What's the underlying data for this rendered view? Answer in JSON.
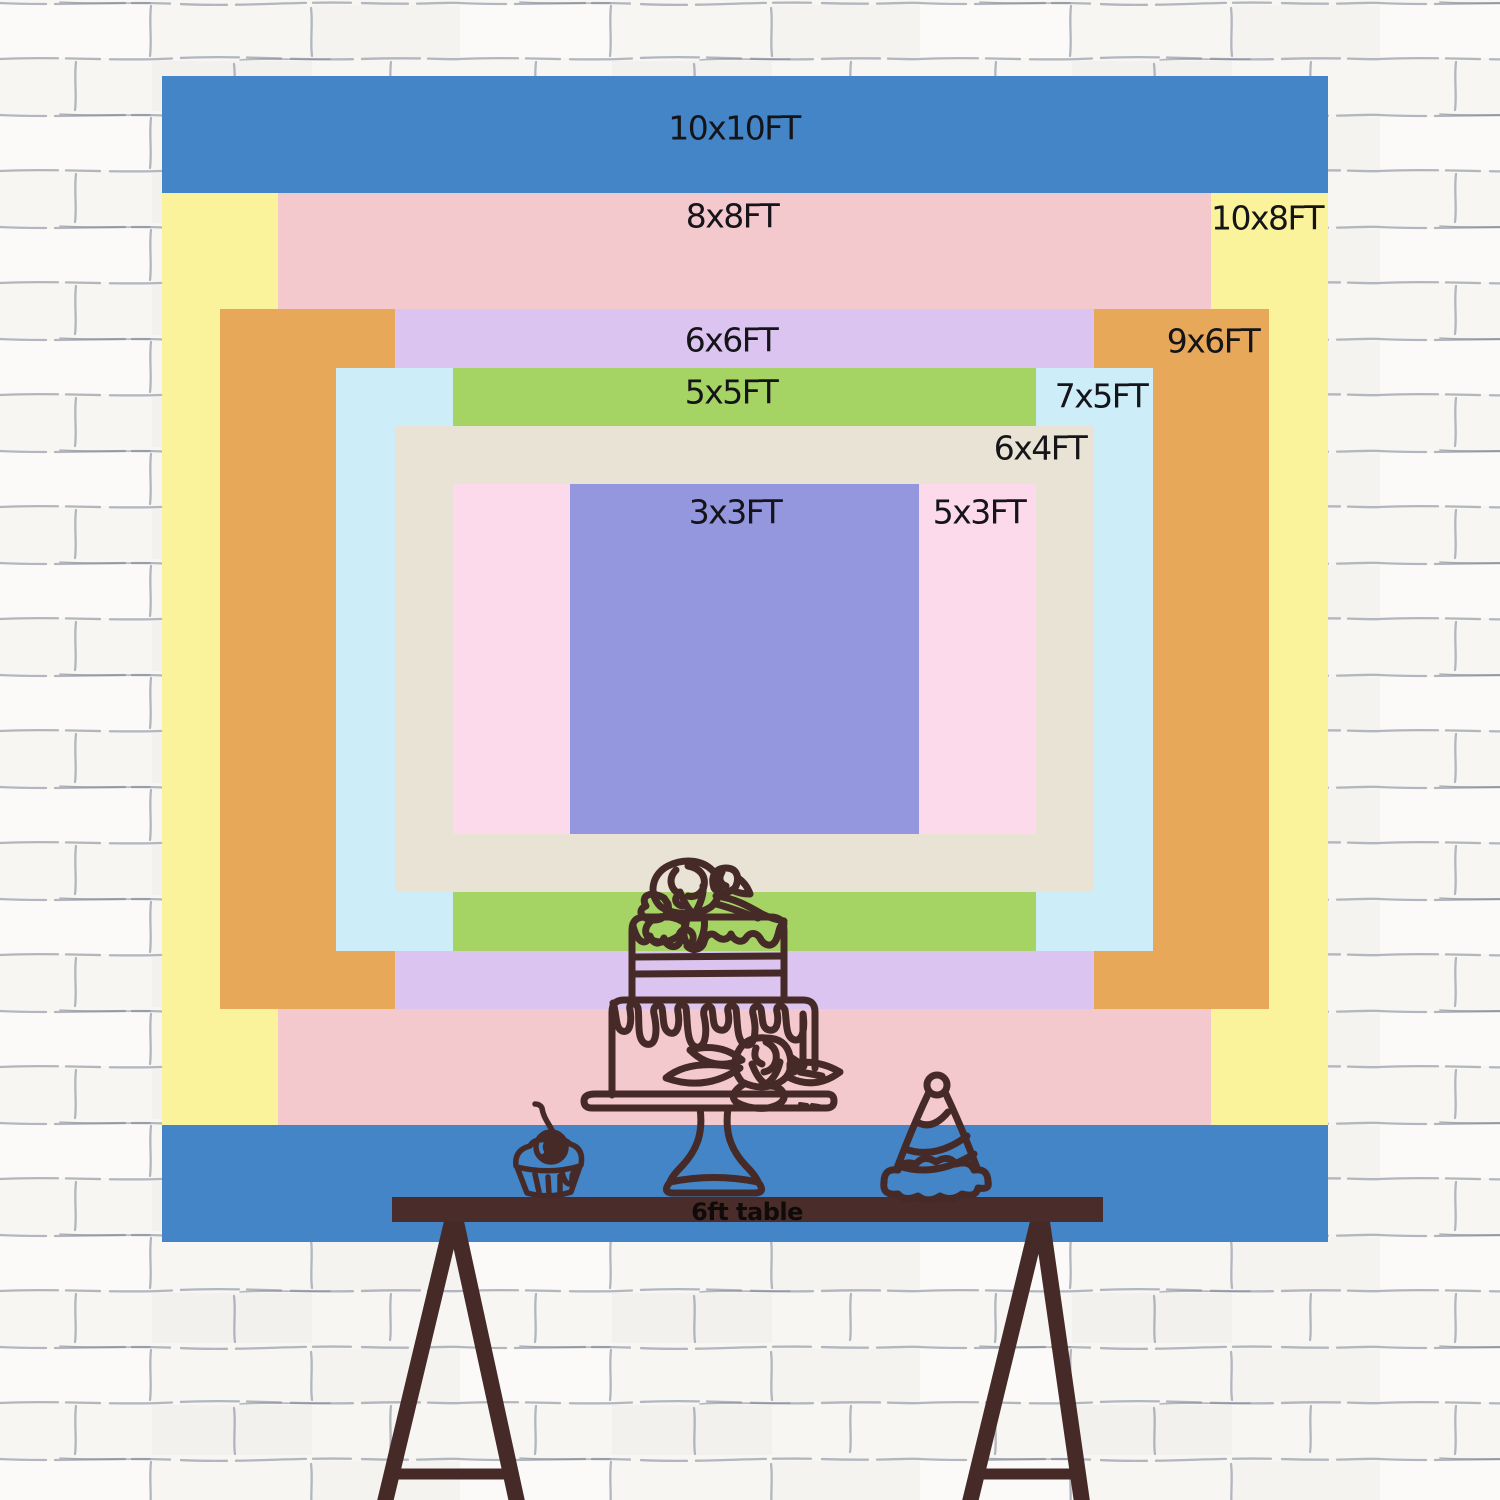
{
  "scene": {
    "type": "backdrop size comparison chart on brick wall",
    "wall": {
      "background": "#f7f6f2",
      "mortar_line_color": "#9aa0ae"
    }
  },
  "size_chart": {
    "unit": "FT",
    "text_color": "#141419",
    "sizes": [
      {
        "id": "10x10",
        "label": "10x10FT",
        "width_ft": 10,
        "height_ft": 10,
        "color": "#4385c6"
      },
      {
        "id": "10x8",
        "label": "10x8FT",
        "width_ft": 10,
        "height_ft": 8,
        "color": "#fbf39c"
      },
      {
        "id": "8x8",
        "label": "8x8FT",
        "width_ft": 8,
        "height_ft": 8,
        "color": "#f4c9cd"
      },
      {
        "id": "9x6",
        "label": "9x6FT",
        "width_ft": 9,
        "height_ft": 6,
        "color": "#e8a85a"
      },
      {
        "id": "6x6",
        "label": "6x6FT",
        "width_ft": 6,
        "height_ft": 6,
        "color": "#dbc4f0"
      },
      {
        "id": "7x5",
        "label": "7x5FT",
        "width_ft": 7,
        "height_ft": 5,
        "color": "#cdedf8"
      },
      {
        "id": "5x5",
        "label": "5x5FT",
        "width_ft": 5,
        "height_ft": 5,
        "color": "#a5d464"
      },
      {
        "id": "6x4",
        "label": "6x4FT",
        "width_ft": 6,
        "height_ft": 4,
        "color": "#e8e3d4"
      },
      {
        "id": "5x3",
        "label": "5x3FT",
        "width_ft": 5,
        "height_ft": 3,
        "color": "#fcdaeb"
      },
      {
        "id": "3x3",
        "label": "3x3FT",
        "width_ft": 3,
        "height_ft": 3,
        "color": "#9496de"
      }
    ]
  },
  "table": {
    "label": "6ft table",
    "length_ft": 6,
    "color": "#4a2d2a",
    "text_color": "#0e0b0a"
  },
  "decorations": {
    "line_color": "#462a28",
    "items": [
      "cupcake-icon",
      "birthday-cake-icon",
      "party-hat-icon"
    ]
  }
}
